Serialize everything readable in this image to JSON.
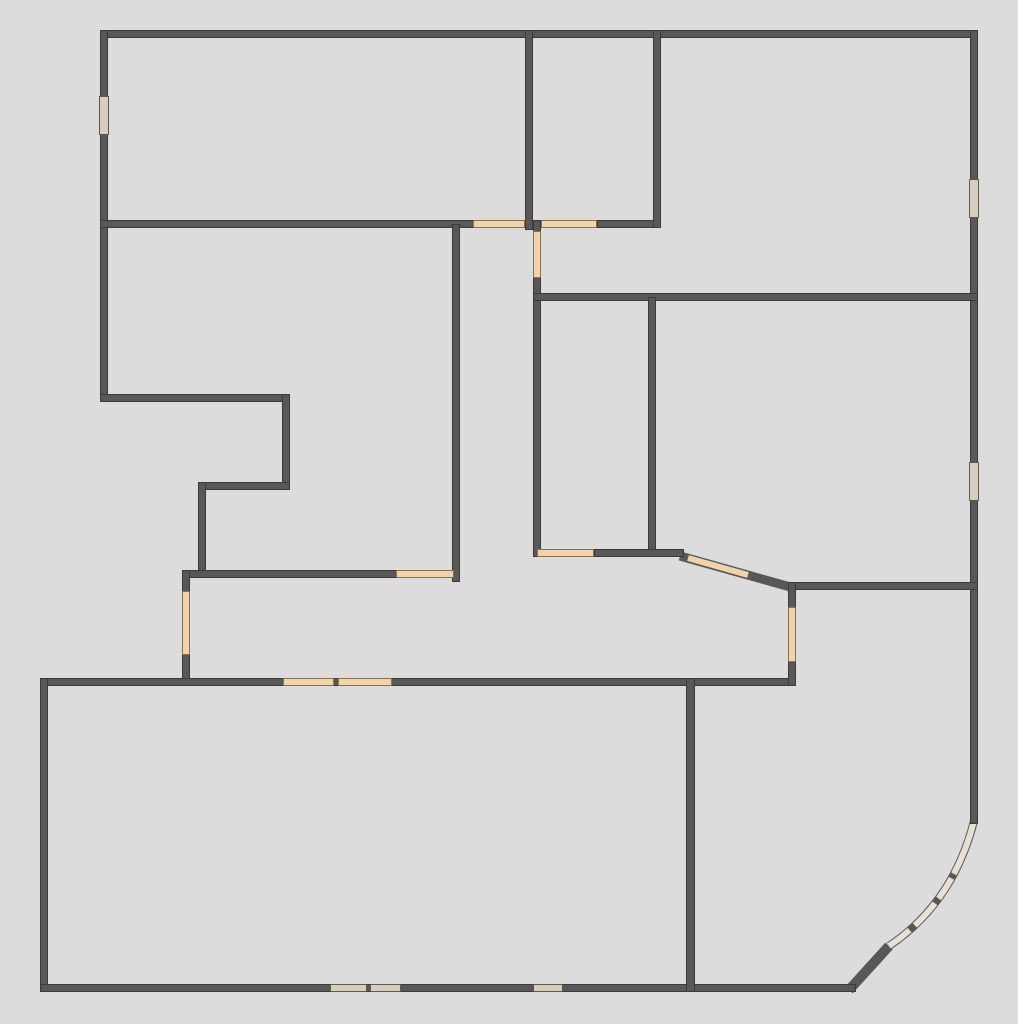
{
  "plan": {
    "name": "apartment-floor-plan",
    "canvas": {
      "width": 1018,
      "height": 1024
    },
    "palette": {
      "background": "#dcdcdc",
      "wall": "#585858",
      "wall_edge": "#3a3a3a",
      "peach": "#f0d3ab",
      "peach_edge": "#8a6f4d",
      "tan": "#d8cec0",
      "tan_edge": "#5f594c",
      "curve_window": "#e7e0d3"
    },
    "walls": [
      {
        "id": "wall-outer-top",
        "x": 100,
        "y": 30,
        "w": 878,
        "h": 8
      },
      {
        "id": "wall-outer-left-upper",
        "x": 100,
        "y": 30,
        "w": 8,
        "h": 372
      },
      {
        "id": "wall-step-horizontal-1",
        "x": 100,
        "y": 394,
        "w": 190,
        "h": 8
      },
      {
        "id": "wall-step-vertical-1",
        "x": 282,
        "y": 394,
        "w": 8,
        "h": 96
      },
      {
        "id": "wall-step-horizontal-2",
        "x": 198,
        "y": 482,
        "w": 92,
        "h": 8
      },
      {
        "id": "wall-step-vertical-2",
        "x": 198,
        "y": 482,
        "w": 8,
        "h": 96
      },
      {
        "id": "wall-hall-south",
        "x": 184,
        "y": 570,
        "w": 276,
        "h": 8
      },
      {
        "id": "wall-entry-vertical-left",
        "x": 182,
        "y": 570,
        "w": 8,
        "h": 116
      },
      {
        "id": "wall-bottom-room-north",
        "x": 40,
        "y": 678,
        "w": 756,
        "h": 8
      },
      {
        "id": "wall-outer-left-lower",
        "x": 40,
        "y": 678,
        "w": 8,
        "h": 314
      },
      {
        "id": "wall-outer-bottom",
        "x": 40,
        "y": 984,
        "w": 816,
        "h": 8
      },
      {
        "id": "wall-outer-right",
        "x": 970,
        "y": 30,
        "w": 8,
        "h": 794
      },
      {
        "id": "wall-east-room-south",
        "x": 790,
        "y": 582,
        "w": 188,
        "h": 8
      },
      {
        "id": "wall-east-room-west",
        "x": 788,
        "y": 582,
        "w": 8,
        "h": 104
      },
      {
        "id": "wall-bottom-rooms-divider",
        "x": 686,
        "y": 678,
        "w": 9,
        "h": 314
      },
      {
        "id": "wall-upper-corridor-west",
        "x": 100,
        "y": 220,
        "w": 375,
        "h": 8
      },
      {
        "id": "wall-top-mid-room-west",
        "x": 525,
        "y": 30,
        "w": 8,
        "h": 200
      },
      {
        "id": "wall-upper-corridor-east",
        "x": 597,
        "y": 220,
        "w": 60,
        "h": 8
      },
      {
        "id": "wall-top-mid-room-east",
        "x": 653,
        "y": 30,
        "w": 8,
        "h": 198
      },
      {
        "id": "wall-center-vertical-right",
        "x": 533,
        "y": 220,
        "w": 8,
        "h": 337
      },
      {
        "id": "wall-right-room-north",
        "x": 533,
        "y": 293,
        "w": 445,
        "h": 8
      },
      {
        "id": "wall-mid-room-divider",
        "x": 648,
        "y": 297,
        "w": 8,
        "h": 260
      },
      {
        "id": "wall-mid-room-south",
        "x": 594,
        "y": 549,
        "w": 90,
        "h": 8
      },
      {
        "id": "wall-center-vertical-left",
        "x": 452,
        "y": 224,
        "w": 8,
        "h": 358
      }
    ],
    "openings": [
      {
        "id": "window-left-wall",
        "tone": "tan",
        "x": 99,
        "y": 96,
        "w": 10,
        "h": 39
      },
      {
        "id": "door-corridor-left",
        "tone": "peach",
        "x": 473,
        "y": 220,
        "w": 52,
        "h": 8
      },
      {
        "id": "door-corridor-right",
        "tone": "peach",
        "x": 541,
        "y": 220,
        "w": 56,
        "h": 8
      },
      {
        "id": "door-center-vertical",
        "tone": "peach",
        "x": 533,
        "y": 231,
        "w": 8,
        "h": 47
      },
      {
        "id": "window-right-wall-upper",
        "tone": "tan",
        "x": 969,
        "y": 179,
        "w": 10,
        "h": 39
      },
      {
        "id": "window-right-wall-lower",
        "tone": "tan",
        "x": 969,
        "y": 462,
        "w": 10,
        "h": 39
      },
      {
        "id": "door-mid-room-south",
        "tone": "peach",
        "x": 537,
        "y": 549,
        "w": 57,
        "h": 8
      },
      {
        "id": "door-hall-south",
        "tone": "peach",
        "x": 396,
        "y": 570,
        "w": 58,
        "h": 8
      },
      {
        "id": "door-entry-vertical",
        "tone": "peach",
        "x": 182,
        "y": 591,
        "w": 8,
        "h": 64
      },
      {
        "id": "door-east-room-west",
        "tone": "peach",
        "x": 788,
        "y": 607,
        "w": 8,
        "h": 55
      },
      {
        "id": "window-bottom-room-north-1",
        "tone": "peach",
        "x": 283,
        "y": 678,
        "w": 51,
        "h": 8
      },
      {
        "id": "window-bottom-room-north-2",
        "tone": "peach",
        "x": 338,
        "y": 678,
        "w": 54,
        "h": 8
      },
      {
        "id": "window-bottom-wall-1",
        "tone": "tan",
        "x": 330,
        "y": 984,
        "w": 37,
        "h": 8
      },
      {
        "id": "window-bottom-wall-2",
        "tone": "tan",
        "x": 370,
        "y": 984,
        "w": 31,
        "h": 8
      },
      {
        "id": "window-bottom-wall-3",
        "tone": "tan",
        "x": 533,
        "y": 984,
        "w": 30,
        "h": 8
      }
    ],
    "diagonals": [
      {
        "id": "wall-diagonal-mid",
        "stroke": "wall",
        "x1": 680,
        "y1": 556,
        "x2": 794,
        "y2": 588,
        "width": 9
      },
      {
        "id": "door-diagonal-mid",
        "stroke": "peach",
        "x1": 688,
        "y1": 558,
        "x2": 748,
        "y2": 575,
        "width": 6
      },
      {
        "id": "wall-diagonal-bottom",
        "stroke": "wall",
        "x1": 849,
        "y1": 990,
        "x2": 889,
        "y2": 946,
        "width": 10
      }
    ],
    "curves": [
      {
        "id": "wall-curve-corner-base",
        "stroke": "wall",
        "d": "M 889,946 Q 953,903 974,821",
        "width": 8,
        "dash": ""
      },
      {
        "id": "window-curve-corner-glass",
        "stroke": "curve",
        "d": "M 889,946 Q 953,903 974,821",
        "width": 6,
        "dash": "26 7 30 6 24 5 60"
      }
    ]
  }
}
